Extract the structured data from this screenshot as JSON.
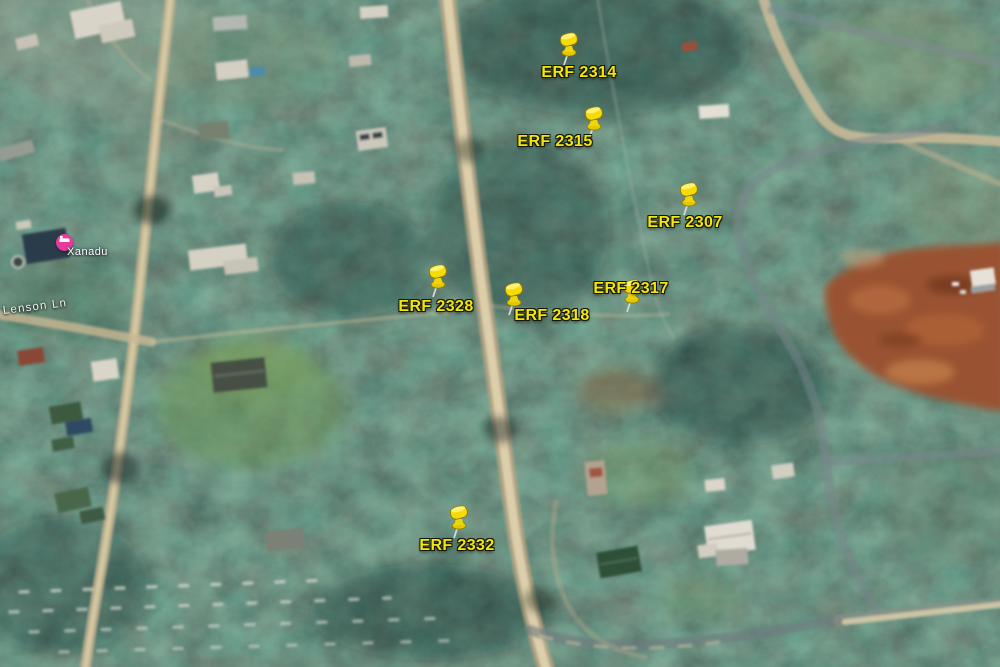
{
  "map": {
    "street_label": "Lenson Ln",
    "poi": {
      "name": "Xanadu",
      "color": "#e83a9e",
      "icon": "lodging-bed-icon"
    },
    "marker_color": "#f4e60c",
    "marker_icon": "yellow-pushpin",
    "markers": [
      {
        "id": "erf-2314",
        "label": "ERF 2314"
      },
      {
        "id": "erf-2315",
        "label": "ERF 2315"
      },
      {
        "id": "erf-2307",
        "label": "ERF 2307"
      },
      {
        "id": "erf-2317",
        "label": "ERF 2317"
      },
      {
        "id": "erf-2318",
        "label": "ERF 2318"
      },
      {
        "id": "erf-2328",
        "label": "ERF 2328"
      },
      {
        "id": "erf-2332",
        "label": "ERF 2332"
      }
    ]
  }
}
